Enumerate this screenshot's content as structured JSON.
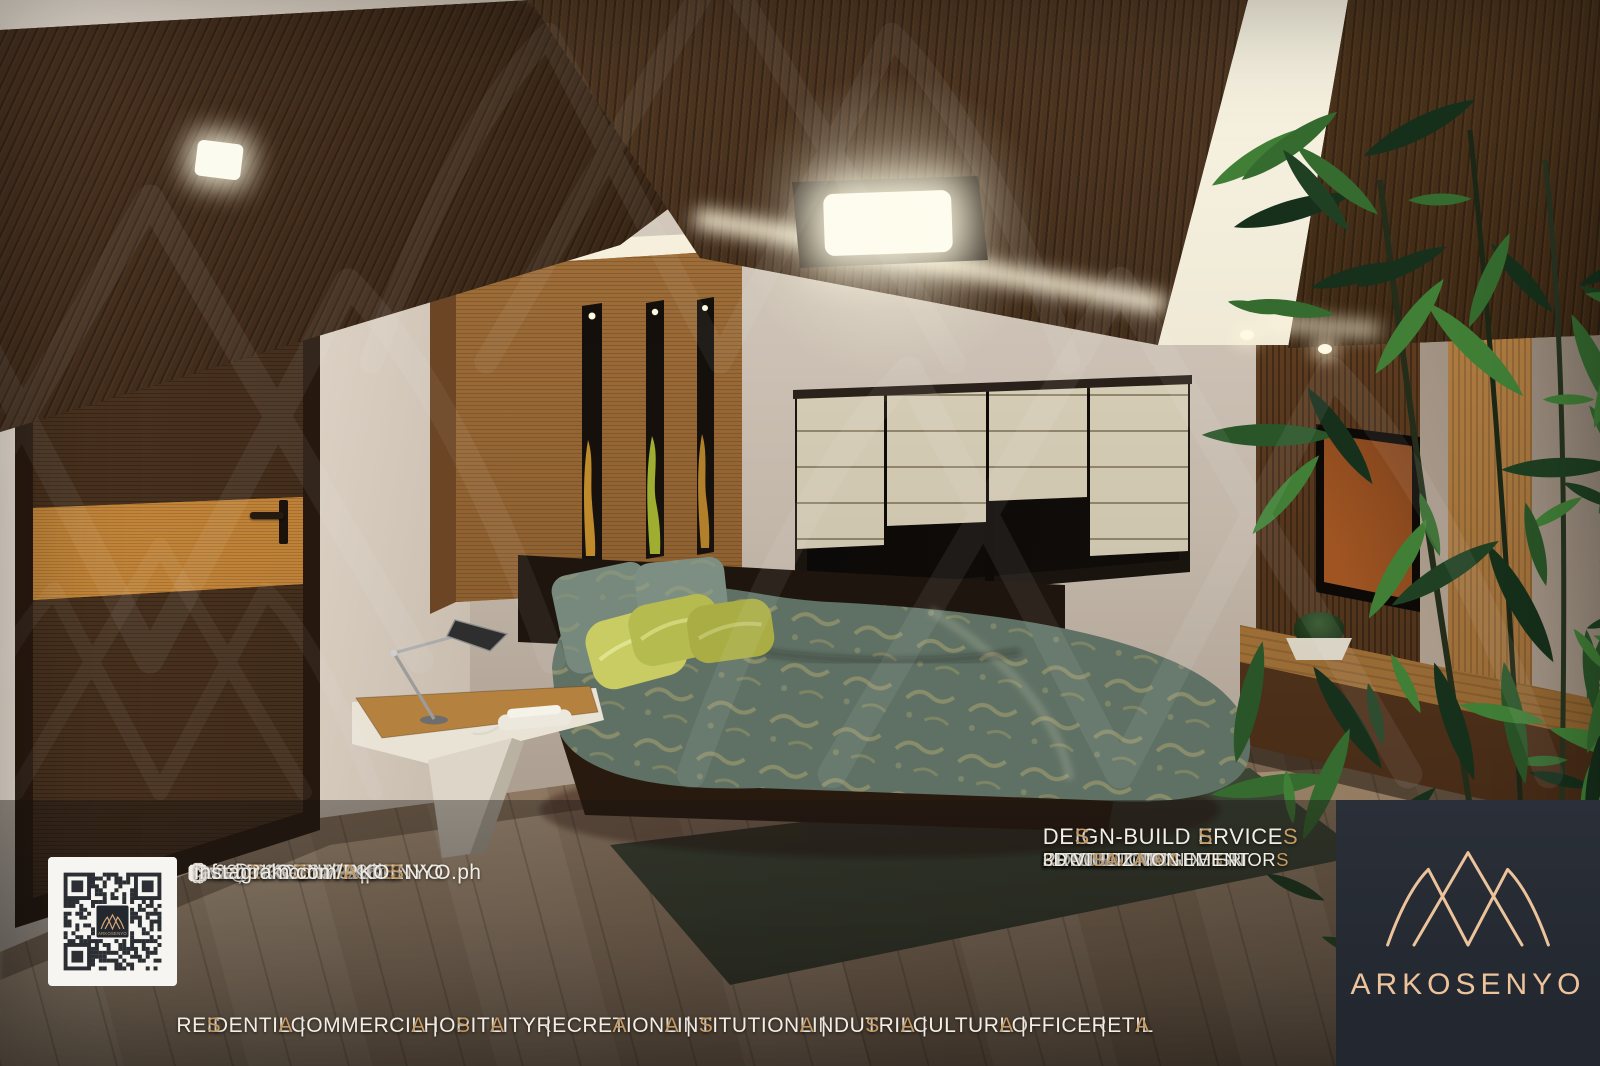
{
  "brand": {
    "name": "ARKOSENYO",
    "accent_color": "#c59a63",
    "logo_color": "#ecc39b",
    "panel_color": "#262b33"
  },
  "contact": {
    "phone": "(+63) 908-8648888",
    "email": "info@ARKOSENYO.ph",
    "website": "www.ARKOSENYO.ph",
    "facebook": "facebook.com/ARKOSENYO",
    "instagram": "instagram.com/ARKOSENYO.ph"
  },
  "services": {
    "header": "DESIGN-BUILD SERVICES",
    "items": [
      "ARCHITECTURAL DESIGN",
      "ARCHITECTURAL INTERIORS",
      "CONSTRUCTION",
      "RENOVATION",
      "FIT-OUT",
      "PROJECT MANAGEMENT",
      "3D VISUALIZATION"
    ]
  },
  "footer": {
    "sectors": [
      "RESIDENTIAL",
      "COMMERCIAL",
      "HOSPITALITY",
      "RECREATIONAL",
      "INSTITUTIONAL",
      "INDUSTRIAL",
      "CULTURAL",
      "OFFICE",
      "RETAIL"
    ],
    "separator": "|"
  }
}
